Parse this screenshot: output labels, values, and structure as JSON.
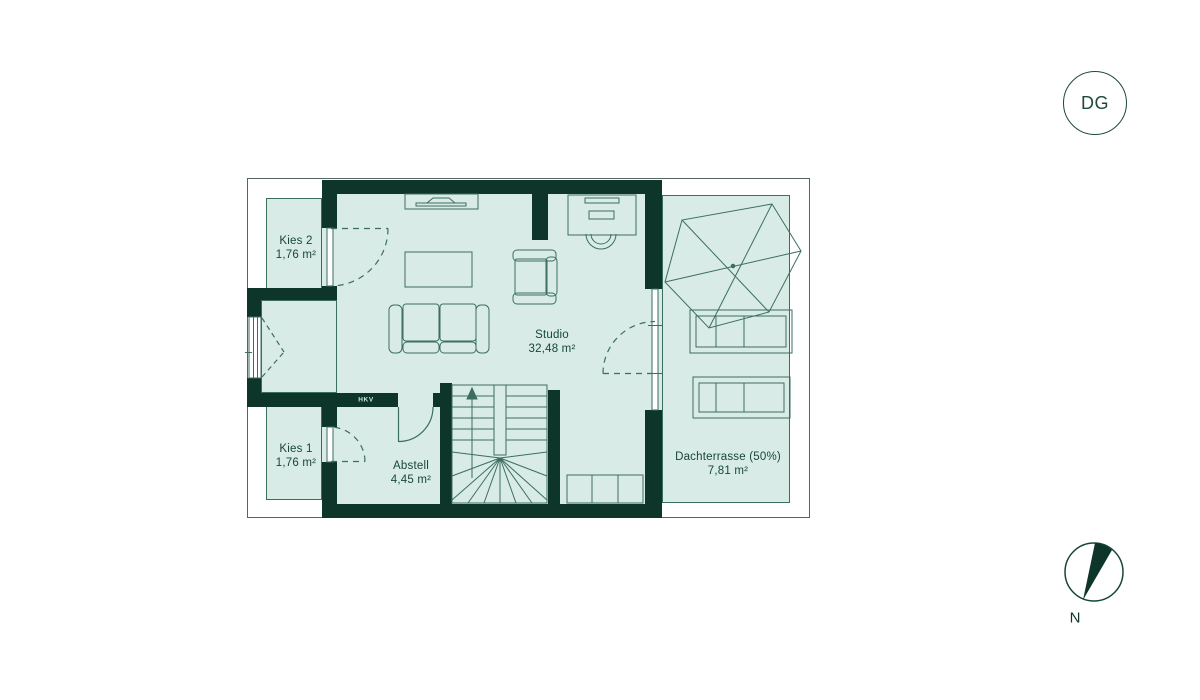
{
  "floor_badge": {
    "label": "DG"
  },
  "compass": {
    "label": "N"
  },
  "rooms": [
    {
      "id": "kies2",
      "name": "Kies 2",
      "area": "1,76 m²"
    },
    {
      "id": "kies1",
      "name": "Kies 1",
      "area": "1,76 m²"
    },
    {
      "id": "studio",
      "name": "Studio",
      "area": "32,48 m²"
    },
    {
      "id": "abstell",
      "name": "Abstell",
      "area": "4,45 m²"
    },
    {
      "id": "terrace",
      "name": "Dachterrasse (50%)",
      "area": "7,81 m²"
    }
  ],
  "wall_labels": {
    "hkv": "HKV"
  },
  "colors": {
    "wall": "#0d352a",
    "floor": "#d8ebe6",
    "thin_line": "#3c6e60",
    "boundary": "#55665f",
    "text": "#17463a",
    "background": "#ffffff"
  }
}
